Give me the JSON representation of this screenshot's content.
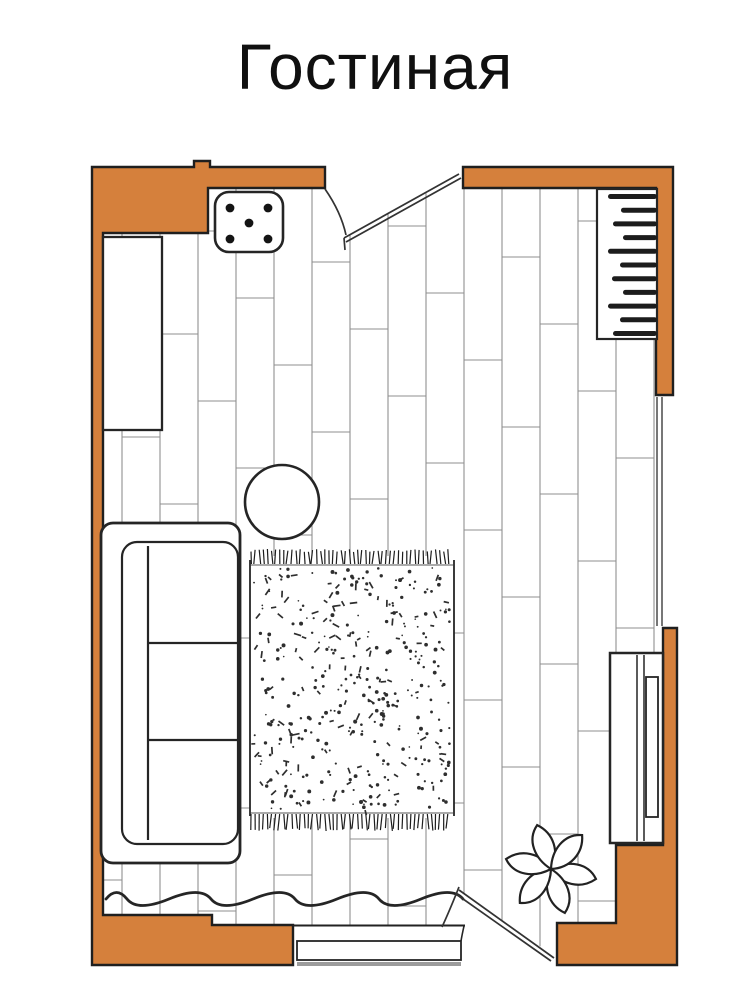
{
  "title": "Гостиная",
  "colors": {
    "background": "#ffffff",
    "wall": "#d5803c",
    "wall_outline": "#1f1f1f",
    "floor_line": "#8f8f8f",
    "furniture_outline": "#252525",
    "rug_speckle": "#2e2e2e",
    "window_line": "#4a4a4a",
    "threshold_gray": "#9c9c9c"
  },
  "icons": {
    "sofa": "sofa-icon",
    "rug": "rug-icon",
    "round_table": "round-coffee-table-icon",
    "stool": "stool-icon",
    "cabinet": "cabinet-icon",
    "radiator": "radiator-icon",
    "tv_stand": "tv-stand-icon",
    "plant": "plant-icon",
    "door_top": "door-swing-icon",
    "door_bottom": "door-swing-icon",
    "window": "window-icon",
    "curtain": "curtain-wave-icon",
    "threshold": "doorway-threshold-icon"
  }
}
